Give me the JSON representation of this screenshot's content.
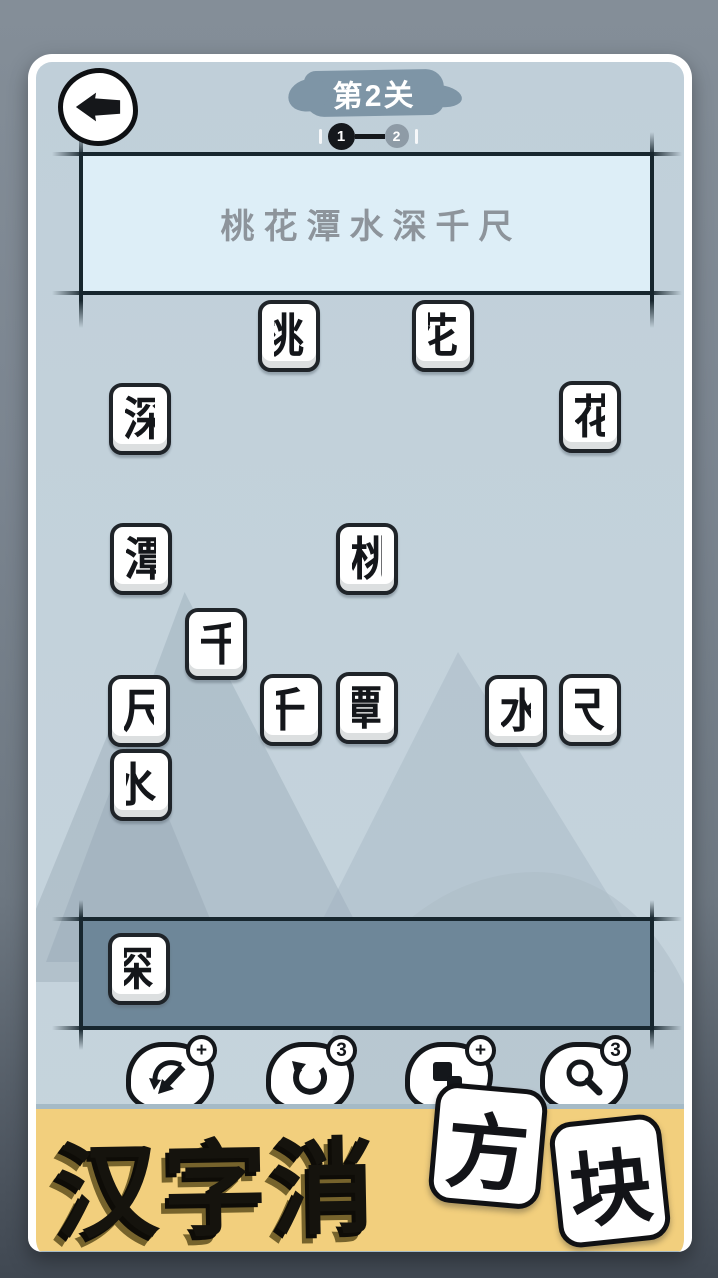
{
  "header": {
    "back_button": "back-arrow",
    "level_banner": {
      "label": "第2关"
    },
    "progress": {
      "current": "1",
      "next": "2"
    }
  },
  "puzzle": {
    "clue_line": "桃花潭水深千尺",
    "board_tiles": [
      {
        "char": "桃",
        "part": "right",
        "desc": "right half of 桃 (兆-like strokes)",
        "x": 250,
        "y": 292
      },
      {
        "char": "花",
        "part": "right",
        "desc": "right half of 花 (十 over 匕)",
        "x": 404,
        "y": 292
      },
      {
        "char": "深",
        "part": "left",
        "desc": "left half of 深 (氵)",
        "x": 101,
        "y": 375
      },
      {
        "char": "花",
        "part": "left",
        "desc": "left half of 花 (十 over 亻)",
        "x": 551,
        "y": 373
      },
      {
        "char": "潭",
        "part": "left",
        "desc": "left half of 潭 (氵 + edge of 覃)",
        "x": 102,
        "y": 515
      },
      {
        "char": "桃",
        "part": "left",
        "desc": "left half of 桃 (木)",
        "x": 328,
        "y": 515
      },
      {
        "char": "千",
        "part": "left",
        "desc": "left half of 千 (F-like strokes)",
        "x": 177,
        "y": 600
      },
      {
        "char": "尺",
        "part": "left",
        "desc": "left half of 尺 (hooked F shape)",
        "x": 100,
        "y": 667
      },
      {
        "char": "千",
        "part": "right",
        "desc": "right half of 千 (mirrored-F)",
        "x": 252,
        "y": 666
      },
      {
        "char": "潭",
        "part": "right",
        "desc": "right half of 潭 (narrow 覃)",
        "x": 328,
        "y": 664
      },
      {
        "char": "水",
        "part": "left",
        "desc": "left half of 水 (㇊-like hook)",
        "x": 477,
        "y": 667
      },
      {
        "char": "尺",
        "part": "right",
        "desc": "right half of 尺 (㇆ + stroke)",
        "x": 551,
        "y": 666
      },
      {
        "char": "水",
        "part": "right",
        "desc": "right half of 水 (卜-like strokes)",
        "x": 102,
        "y": 741
      }
    ],
    "tray_tiles": [
      {
        "char": "深",
        "part": "right",
        "desc": "right half of 深 (罙)",
        "x": 100,
        "y": 925
      }
    ]
  },
  "toolbar": {
    "buttons": [
      {
        "name": "shuffle",
        "icon": "shuffle-arrows-icon",
        "badge": "+"
      },
      {
        "name": "undo",
        "icon": "undo-arrow-icon",
        "badge": "3"
      },
      {
        "name": "add-block",
        "icon": "blocks-icon",
        "badge": "+"
      },
      {
        "name": "magnifier",
        "icon": "magnifier-icon",
        "badge": "3"
      }
    ]
  },
  "branding": {
    "title": "汉字消方块",
    "banner_text": "汉字消",
    "tile_chars": [
      "方",
      "块"
    ]
  },
  "colors": {
    "outer_top": "#848e98",
    "outer_bottom": "#404852",
    "screen_bg": "#c3d2db",
    "clue_box": "#ddeef7",
    "tray_fill": "#6e8799",
    "line_ink": "#17262e",
    "tile_face": "#ffffff",
    "tile_border": "#1f2429",
    "banner_yellow": "#f2cf7d",
    "banner_border": "#a5bac6",
    "level_brush": "#7e95a6",
    "progress_active": "#15181c",
    "progress_inactive": "#8e9ba6",
    "clue_text": "#8d949b"
  }
}
